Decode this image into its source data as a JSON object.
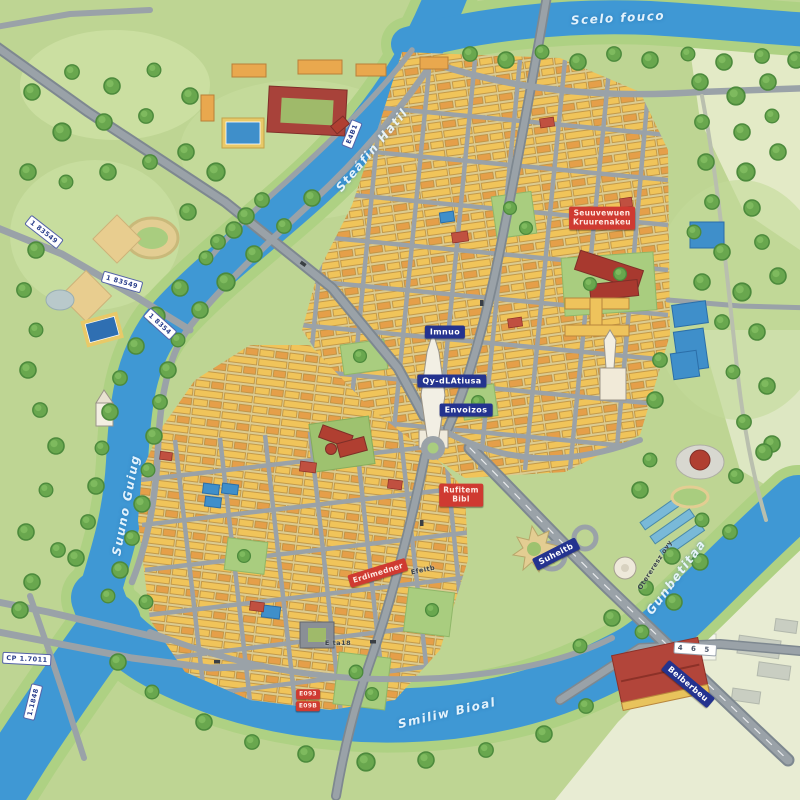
{
  "map_title": "Illustrated city map",
  "rivers": {
    "top": "Scelo fouco",
    "northwest": "Steáfin Hatil",
    "west": "Suuno Guiug",
    "south": "Smiliw Bioal",
    "east": "Gunbetitaa"
  },
  "poi_blue": [
    "Imnuo",
    "Qy-dLAtiusa",
    "Envoizos",
    "Suheitb",
    "Beiberbeu"
  ],
  "poi_red": {
    "big": {
      "line1": "Seuuvewuen",
      "line2": "Kruurenakeu"
    },
    "mid": {
      "line1": "Rufitem",
      "line2": "Bibl"
    },
    "banner": "Erdimedner",
    "tag1": "E093",
    "tag2": "E09B"
  },
  "route_shields": [
    "1 83549",
    "1 83549",
    "1 8354",
    "E4B1",
    "CP 1.7011",
    "1.1848",
    "4 6 5"
  ],
  "street_labels": [
    "Otereresz ovy",
    "Efeitb",
    "E ta18"
  ],
  "colors": {
    "river": "#3f98d4",
    "parkland": "#bed593",
    "blocks_yellow": "#f0c45a",
    "blocks_orange": "#e59f49",
    "landmark_red": "#ad4136",
    "label_blue": "#24338f",
    "label_red": "#cf3a31",
    "road_gray": "#9aa2a8"
  }
}
